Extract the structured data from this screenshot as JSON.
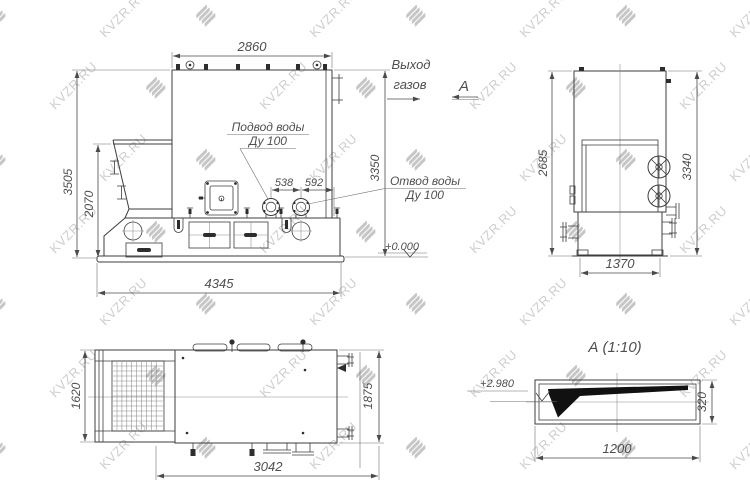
{
  "watermark": {
    "text": "KVZR.RU"
  },
  "colors": {
    "line": "#3d3d3d",
    "dimension_text": "#4f4f4f",
    "watermark": "#c6c6c6",
    "background": "#ffffff",
    "section_fill": "#111111"
  },
  "front_view": {
    "dim_top": "2860",
    "dim_left_outer": "3505",
    "dim_left_inner": "2070",
    "dim_right": "3350",
    "dim_bottom": "4345",
    "dim_pipe_1": "538",
    "dim_pipe_2": "592",
    "label_inlet_line1": "Подвод воды",
    "label_inlet_line2": "Ду 100",
    "label_outlet_line1": "Отвод воды",
    "label_outlet_line2": "Ду 100",
    "label_gas_line1": "Выход",
    "label_gas_line2": "газов",
    "section_arrow_label": "А",
    "level_mark": "+0.000"
  },
  "side_view": {
    "dim_left": "2685",
    "dim_right": "3340",
    "dim_bottom": "1370"
  },
  "plan_view": {
    "dim_left": "1620",
    "dim_right": "1875",
    "dim_bottom": "3042"
  },
  "section_view": {
    "title": "А (1:10)",
    "level_mark": "+2.980",
    "dim_right": "320",
    "dim_bottom": "1200"
  }
}
